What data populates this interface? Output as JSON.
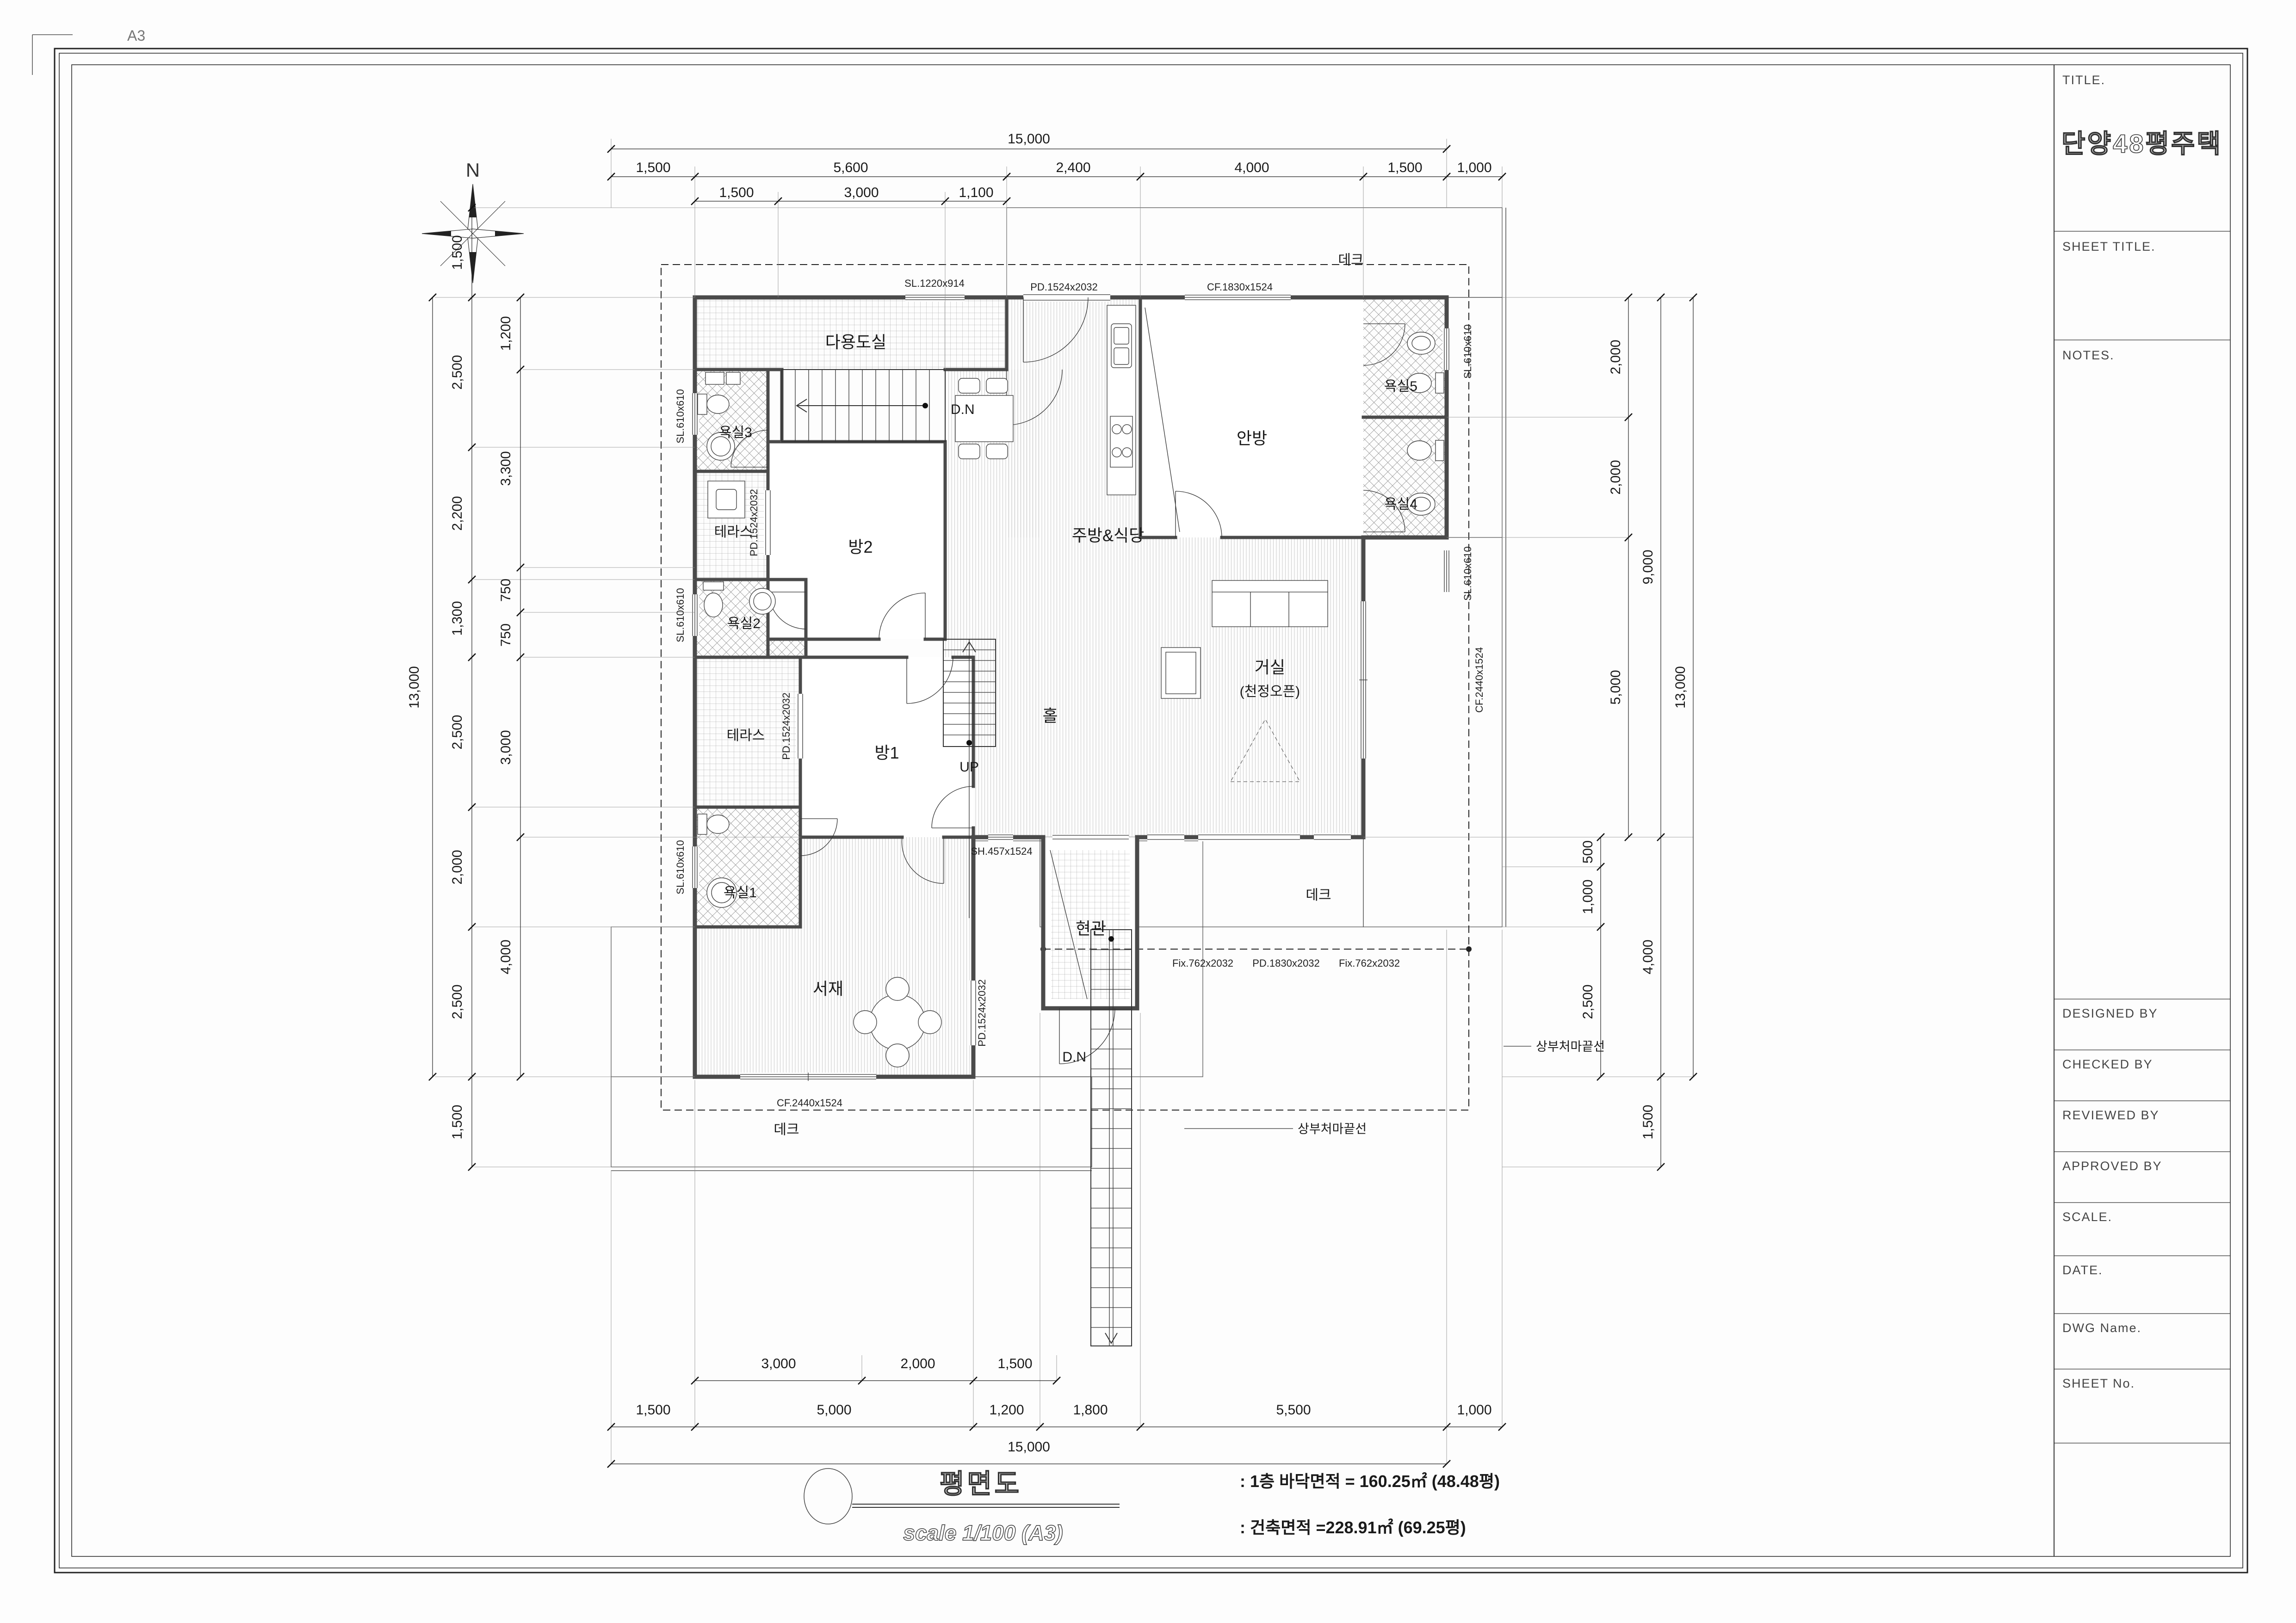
{
  "sheet": {
    "size_label": "A3"
  },
  "compass": {
    "north": "N"
  },
  "rooms": {
    "utility": "다용도실",
    "bath3": "욕실3",
    "room2": "방2",
    "terrace1": "테라스",
    "bath2": "욕실2",
    "room1": "방1",
    "terrace2": "테라스",
    "bath1": "욕실1",
    "study": "서재",
    "hall": "홀",
    "entrance": "현관",
    "kitchen": "주방&식당",
    "master": "안방",
    "bath5": "욕실5",
    "bath4": "욕실4",
    "living": "거실",
    "living_note": "(천정오픈)",
    "deck_top": "데크",
    "deck_bottom_right": "데크",
    "deck_bottom_left": "데크"
  },
  "stairs": {
    "up": "UP",
    "down_interior": "D.N",
    "down_exterior": "D.N"
  },
  "openings": {
    "sl_1220": "SL.1220x914",
    "pd_1524_top": "PD.1524x2032",
    "cf_1830": "CF.1830x1524",
    "sl_610_b3": "SL.610x610",
    "sl_610_b2": "SL.610x610",
    "sl_610_b1": "SL.610x610",
    "sl_610_b5": "SL.610x610",
    "sl_610_b4": "SL.610x610",
    "pd_1524_t1": "PD.1524x2032",
    "pd_1524_t2": "PD.1524x2032",
    "pd_1524_study": "PD.1524x2032",
    "cf_2440_living": "CF.2440x1524",
    "cf_2440_study": "CF.2440x1524",
    "sh_457": "SH.457x1524",
    "fix_762_a": "Fix.762x2032",
    "pd_1830": "PD.1830x2032",
    "fix_762_b": "Fix.762x2032"
  },
  "annotations": {
    "eave_right": "상부처마끝선",
    "eave_bottom": "상부처마끝선"
  },
  "dims": {
    "top": {
      "total": "15,000",
      "row2": [
        "1,500",
        "5,600",
        "2,400",
        "4,000",
        "1,500",
        "1,000"
      ],
      "row3": [
        "1,500",
        "3,000",
        "1,100"
      ]
    },
    "bottom": {
      "row1": [
        "3,000",
        "2,000",
        "1,500"
      ],
      "row2": [
        "1,500",
        "5,000",
        "1,200",
        "1,800",
        "5,500",
        "1,000"
      ],
      "total": "15,000"
    },
    "left": {
      "total": "13,000",
      "outer": [
        "1,500",
        "2,500",
        "2,200",
        "1,300",
        "2,500",
        "2,000",
        "2,500",
        "1,500"
      ],
      "inner": [
        "1,200",
        "3,300",
        "750",
        "750",
        "3,000",
        "4,000"
      ]
    },
    "right": {
      "sub": [
        "500",
        "1,000",
        "2,500"
      ],
      "inner": [
        "2,000",
        "2,000",
        "5,000"
      ],
      "mid": [
        "9,000",
        "4,000",
        "1,500"
      ],
      "total": "13,000"
    }
  },
  "title_block": {
    "title_label": "TITLE.",
    "project_title": "단양48평주택",
    "sheet_title_label": "SHEET TITLE.",
    "notes_label": "NOTES.",
    "fields": [
      "DESIGNED BY",
      "CHECKED BY",
      "REVIEWED BY",
      "APPROVED BY",
      "SCALE.",
      "DATE.",
      "DWG Name.",
      "SHEET No."
    ]
  },
  "footer": {
    "drawing_name": "평면도",
    "scale": "scale 1/100 (A3)",
    "area1": ": 1층 바닥면적 = 160.25㎡ (48.48평)",
    "area2": ": 건축면적 =228.91㎡ (69.25평)"
  }
}
